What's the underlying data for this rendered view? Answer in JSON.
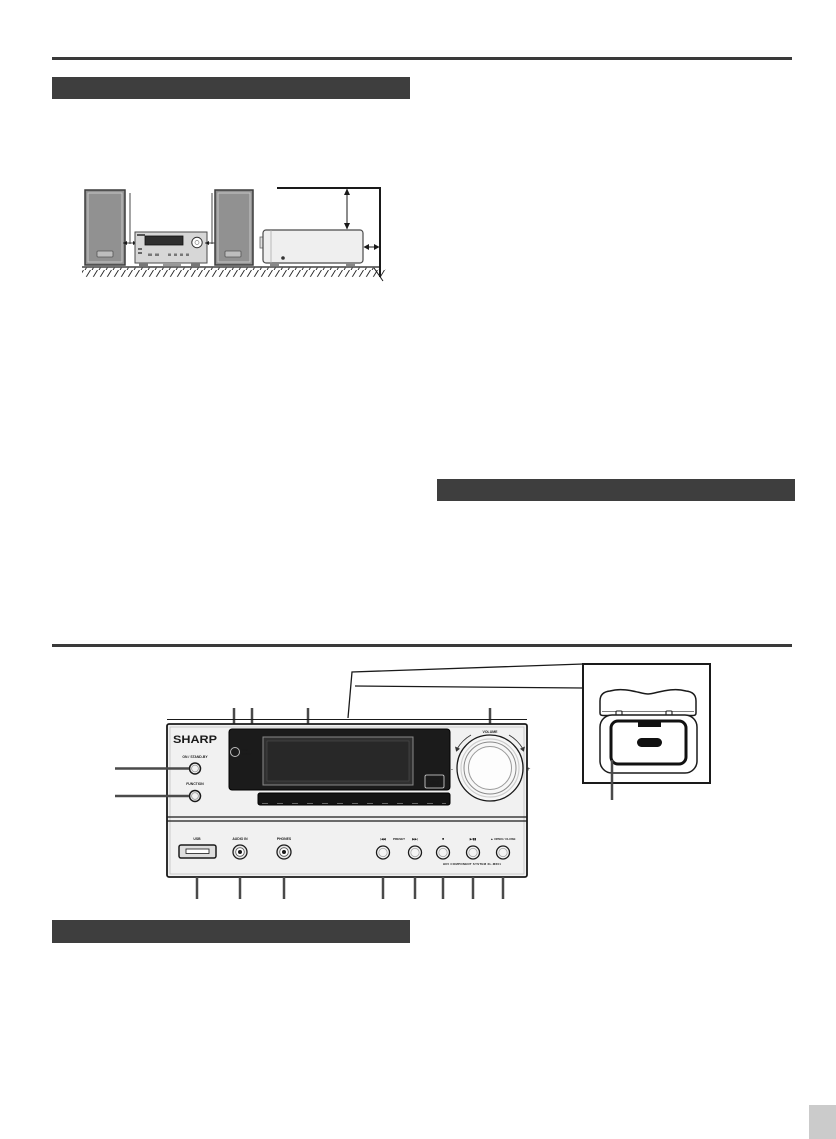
{
  "sections": {
    "bar_top_label": "",
    "bar_right_label": "",
    "bar_bottom_label": "",
    "page_tab_label": ""
  },
  "front_panel": {
    "brand": "SHARP",
    "power_label": "ON / STAND-BY",
    "function_label": "FUNCTION",
    "indicator_line1": "TIMER",
    "indicator_line2": "STAND-BY",
    "cd_badge_top": "COMPACT",
    "cd_badge_main": "disc",
    "cd_badge_bottom": "DIGITAL AUDIO",
    "usb_label": "USB",
    "audio_in_label": "AUDIO IN",
    "phones_label": "PHONES",
    "skip_back_label": "|◀◀",
    "preset_label": "PRESET",
    "skip_forward_label": "▶▶|",
    "stop_label": "■",
    "play_pause_label": "▶/▮▮",
    "open_close_label": "▲ OPEN / CLOSE",
    "volume_label": "VOLUME",
    "volume_minus": "-",
    "volume_plus": "+",
    "model_label": "HIFI COMPONENT SYSTEM XL-M601"
  }
}
